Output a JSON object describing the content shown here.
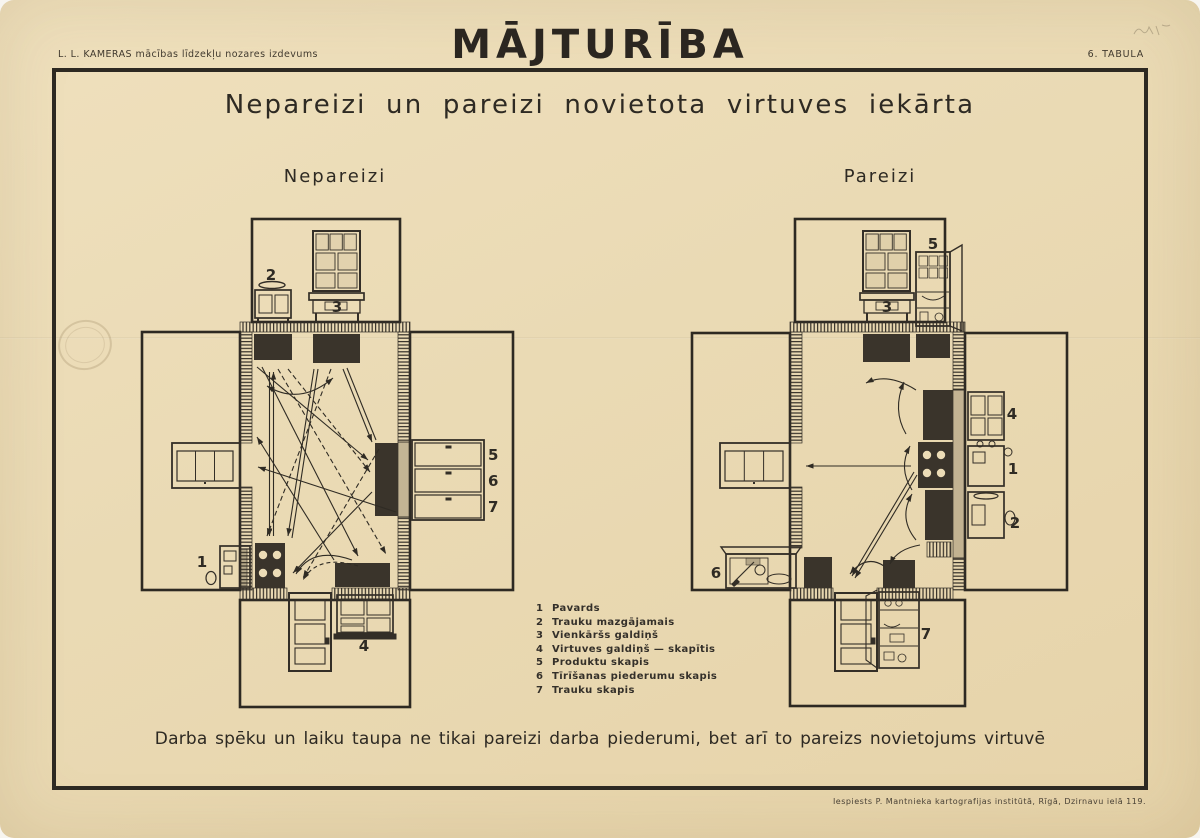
{
  "header": {
    "publisher": "L. L. KAMERAS mācības līdzekļu nozares izdevums",
    "title": "MĀJTURĪBA",
    "table_number": "6. TABULA"
  },
  "poster": {
    "main_title": "Nepareizi un pareizi novietota virtuves iekārta",
    "caption": "Darba spēku un laiku taupa ne tikai pareizi darba piederumi, bet arī to pareizs novietojums virtuvē",
    "imprint": "Iespiests P. Mantnieka kartografijas institūtā, Rīgā, Dzirnavu ielā 119."
  },
  "diagrams": {
    "left": {
      "label": "Nepareizi",
      "numbers": {
        "n1": "1",
        "n2": "2",
        "n3": "3",
        "n4": "4",
        "n5": "5",
        "n6": "6",
        "n7": "7"
      }
    },
    "right": {
      "label": "Pareizi",
      "numbers": {
        "n1": "1",
        "n2": "2",
        "n3": "3",
        "n4": "4",
        "n5": "5",
        "n6": "6",
        "n7": "7"
      }
    }
  },
  "legend": {
    "items": [
      {
        "num": "1",
        "label": "Pavards"
      },
      {
        "num": "2",
        "label": "Trauku mazgājamais"
      },
      {
        "num": "3",
        "label": "Vienkāršs galdiņš"
      },
      {
        "num": "4",
        "label": "Virtuves galdiņš — skapītis"
      },
      {
        "num": "5",
        "label": "Produktu skapis"
      },
      {
        "num": "6",
        "label": "Tīrīšanas piederumu skapis"
      },
      {
        "num": "7",
        "label": "Trauku skapis"
      }
    ]
  },
  "colors": {
    "paper": "#eadab4",
    "ink": "#332e27",
    "furniture_fill": "#3a342b"
  }
}
